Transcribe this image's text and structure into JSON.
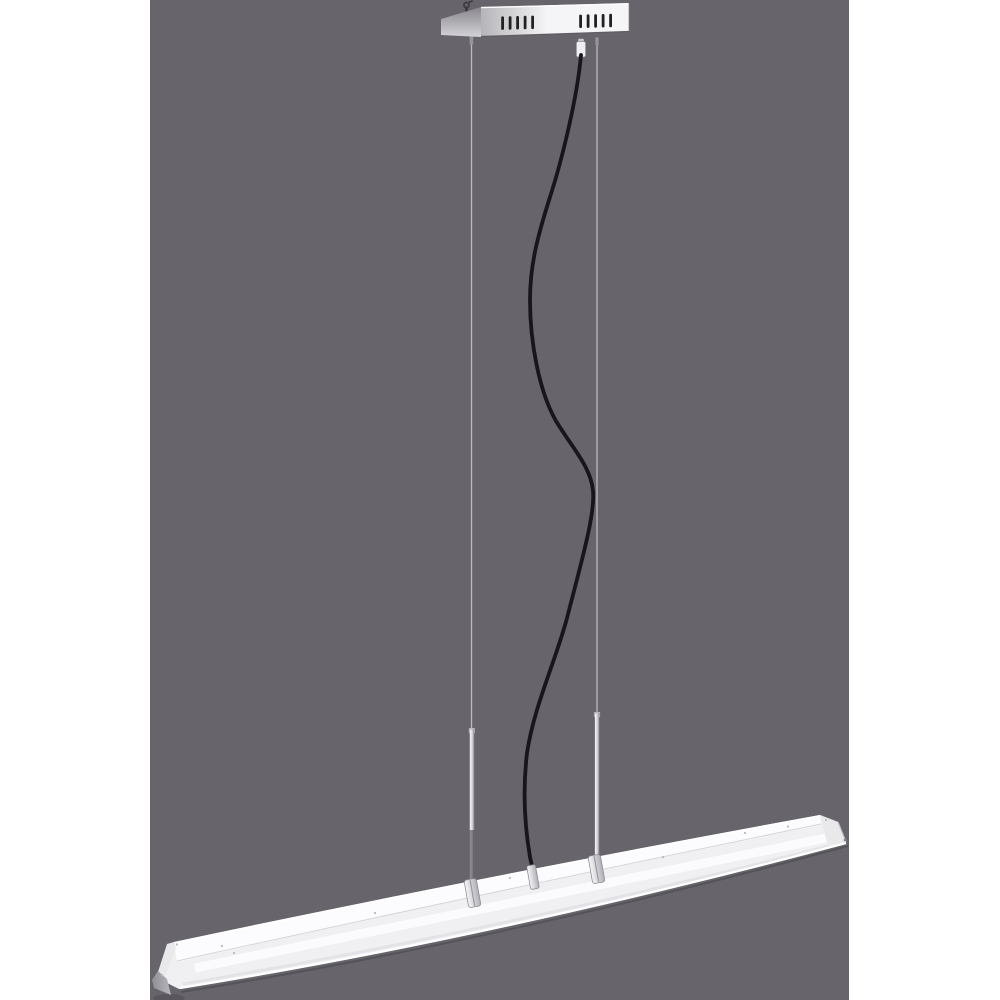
{
  "colors": {
    "page_background": "#ffffff",
    "backdrop": "#67656b",
    "canopy_side_top": "#88868c",
    "canopy_side_bottom": "#d4d4d8",
    "canopy_front_left": "#b5b5b9",
    "canopy_front_right": "#f5f5f7",
    "canopy_top_highlight": "#fdfdfe",
    "canopy_bottom_edge": "#5f5d63",
    "canopy_right_edge": "#c8c8cc",
    "vent_slot": "#212125",
    "mount_hook": "#3a383e",
    "fitting_gray": "#97959c",
    "gland_body": "#f0f0f2",
    "gland_cap": "#c9c8cd",
    "gland_edge": "#908e95",
    "wire": "#bab8c0",
    "rod_hi": "#f6f6f8",
    "rod_mid": "#d8d8dc",
    "rod_shade": "#8a888f",
    "rod_edge": "#7d7b82",
    "rod_bottom_shadow": "rgba(45,43,50,0.5)",
    "cable": "#17171b",
    "connector_light": "#f6f6f8",
    "connector_dark": "#b0afb6",
    "connector_edge": "#85838a",
    "connector_groove": "#9a99a0",
    "bar_body": "#f0f0f3",
    "bar_top_face": "#fcfcfe",
    "bar_top_highlight": "#ffffff",
    "bar_face_line": "#d4d4d8",
    "bar_stripe": "#fbfbfd",
    "bar_inner_shadow": "#e3e3e7",
    "bar_bottom_highlight": "#ffffff",
    "bar_under_shadow": "rgba(58,56,64,0.38)",
    "bar_end_cap": "#e9e9ec",
    "bar_end_cap_edge": "#c2c2c6",
    "bar_tip_light": "#b8b7bd",
    "bar_tip_dark": "#8f8e95",
    "tip_ground_shadow": "rgba(40,40,46,0.22)",
    "screw_dot": "#b9b9bd",
    "screw_dot_dark": "#8a888f"
  }
}
